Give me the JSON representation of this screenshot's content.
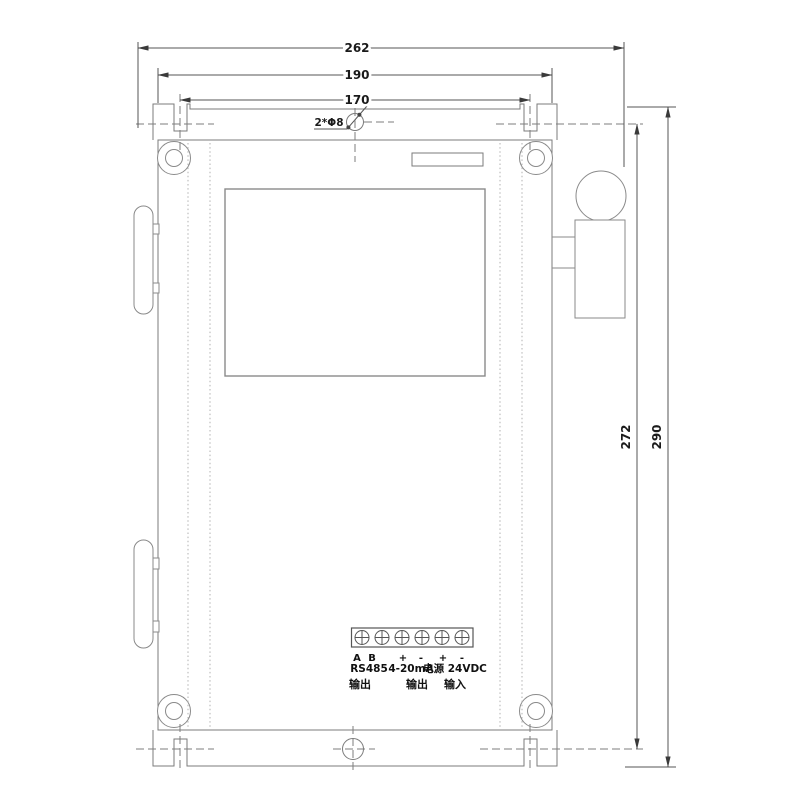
{
  "drawing": {
    "dimensions": {
      "overall_width": "262",
      "body_width": "190",
      "mounting_spacing_horizontal": "170",
      "mounting_spacing_vertical": "272",
      "overall_height": "290",
      "hole_callout": "2*Φ8"
    },
    "terminal_block": {
      "pin_labels": [
        "A",
        "B",
        "+",
        "-",
        "+",
        "-"
      ],
      "groups": [
        {
          "label": "RS485",
          "sub_label": "输出"
        },
        {
          "label": "4-20mA",
          "sub_label": "输出"
        },
        {
          "label": "电源 24VDC",
          "sub_label": "输入"
        }
      ]
    },
    "colors": {
      "line": "#7b7b7b",
      "dim_line": "#555555",
      "text": "#1a1a1a",
      "background": "#ffffff"
    }
  }
}
